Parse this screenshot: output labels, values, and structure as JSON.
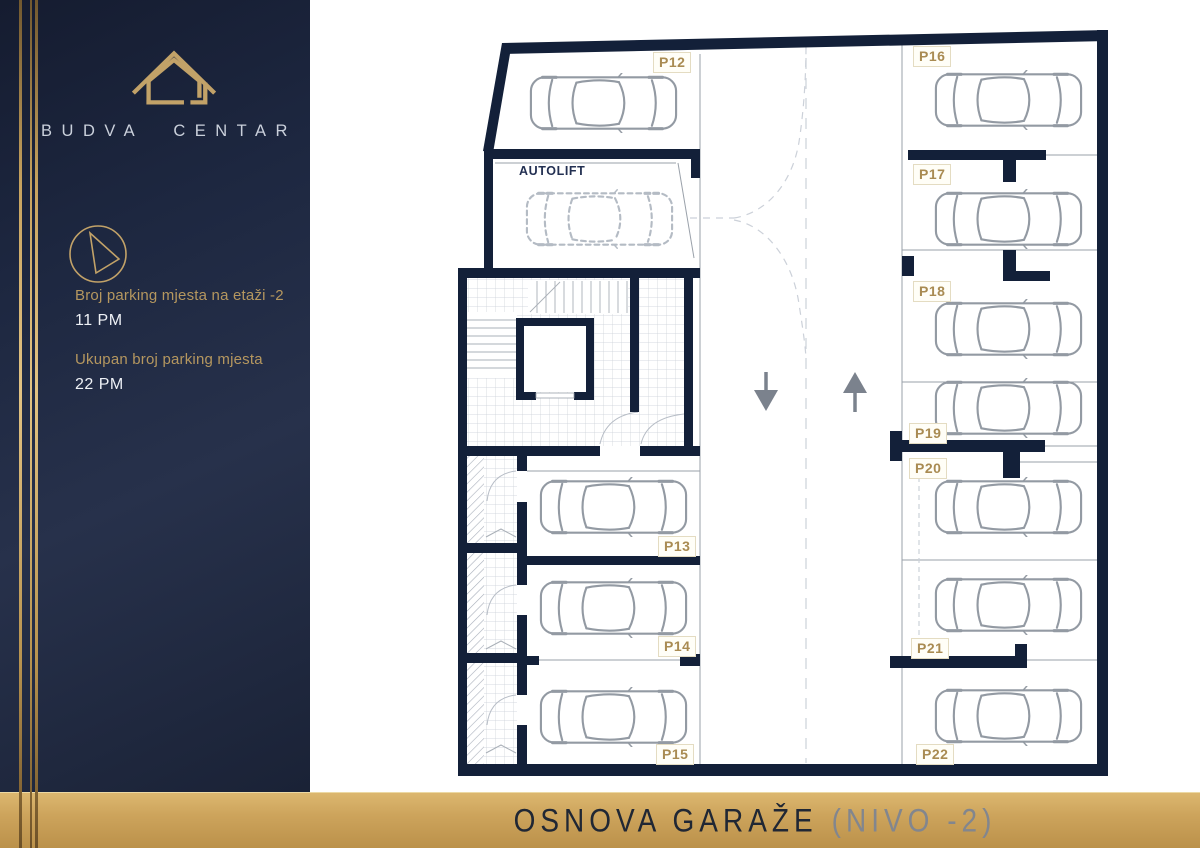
{
  "sidebar": {
    "brand": "BUDVA CENTAR",
    "logo_icon": "house-outline-icon",
    "compass_icon": "compass-needle-icon",
    "stats": [
      {
        "label": "Broj parking mjesta na etaži -2",
        "value": "11 PM"
      },
      {
        "label": "Ukupan broj parking mjesta",
        "value": "22 PM"
      }
    ]
  },
  "plan": {
    "autolift": "AUTOLIFT",
    "spots": [
      "P12",
      "P13",
      "P14",
      "P15",
      "P16",
      "P17",
      "P18",
      "P19",
      "P20",
      "P21",
      "P22"
    ],
    "traffic_arrows": [
      "down",
      "up"
    ]
  },
  "footer": {
    "title": "OSNOVA GARAŽE",
    "level": "(NIVO -2)"
  },
  "colors": {
    "accent_gold": "#c7a35f",
    "navy": "#1d2740",
    "wall": "#132039",
    "label_gold": "#a98b52",
    "car_outline": "#939aa3"
  }
}
